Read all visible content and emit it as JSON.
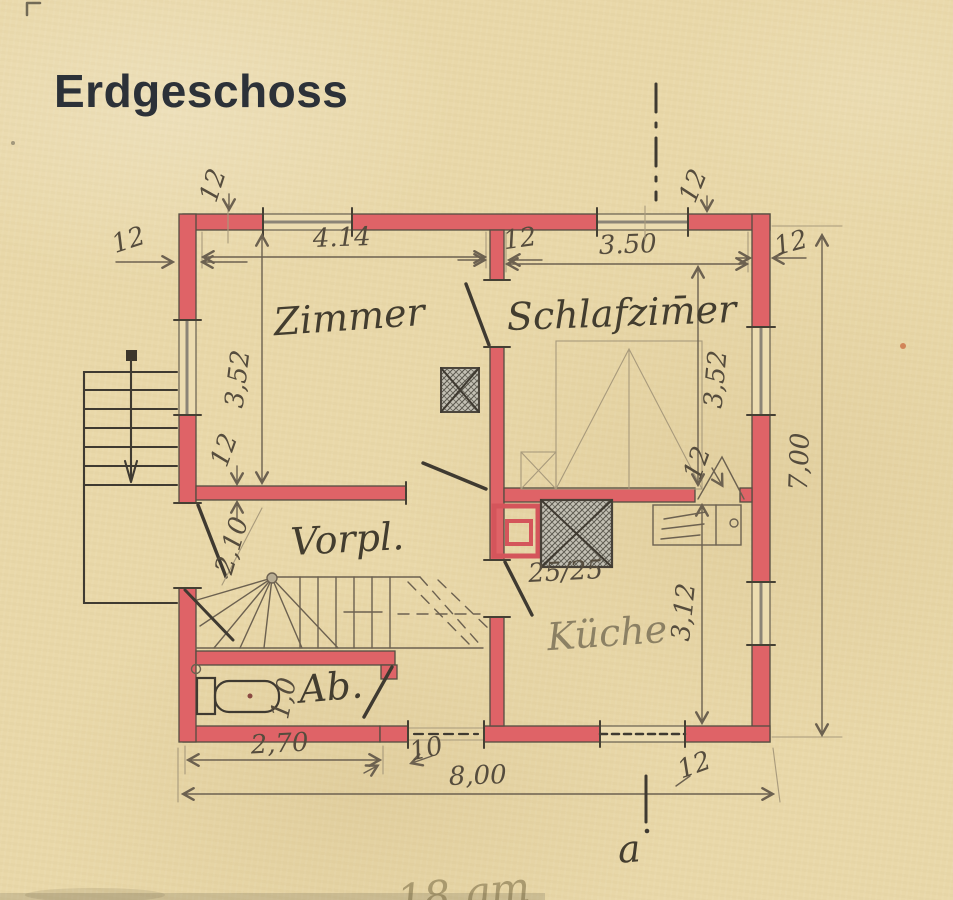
{
  "title": "Erdgeschoss",
  "footer_note": "18 qm",
  "section_marker": "a",
  "colors": {
    "paper": "#e9d8a9",
    "wall_red": "#df6367",
    "ink": "#3f3a31",
    "pencil": "#6c6150"
  },
  "rooms": {
    "zimmer": "Zimmer",
    "schlafzimmer": "Schlafzim̄er",
    "vorplatz": "Vorpl.",
    "kueche": "Küche",
    "abort": "Ab."
  },
  "dimensions": {
    "zimmer_width": "4.14",
    "schlafzimmer_width": "3.50",
    "zimmer_depth": "3,52",
    "schlafzimmer_depth": "3,52",
    "house_depth": "7,00",
    "kueche_depth": "3,12",
    "vorplatz_diag": "2,10",
    "ab_width": "2,70",
    "ab_height": "1,0",
    "house_width": "8,00",
    "pier": "10",
    "chimney": "25/25",
    "wall_thickness": "12"
  }
}
